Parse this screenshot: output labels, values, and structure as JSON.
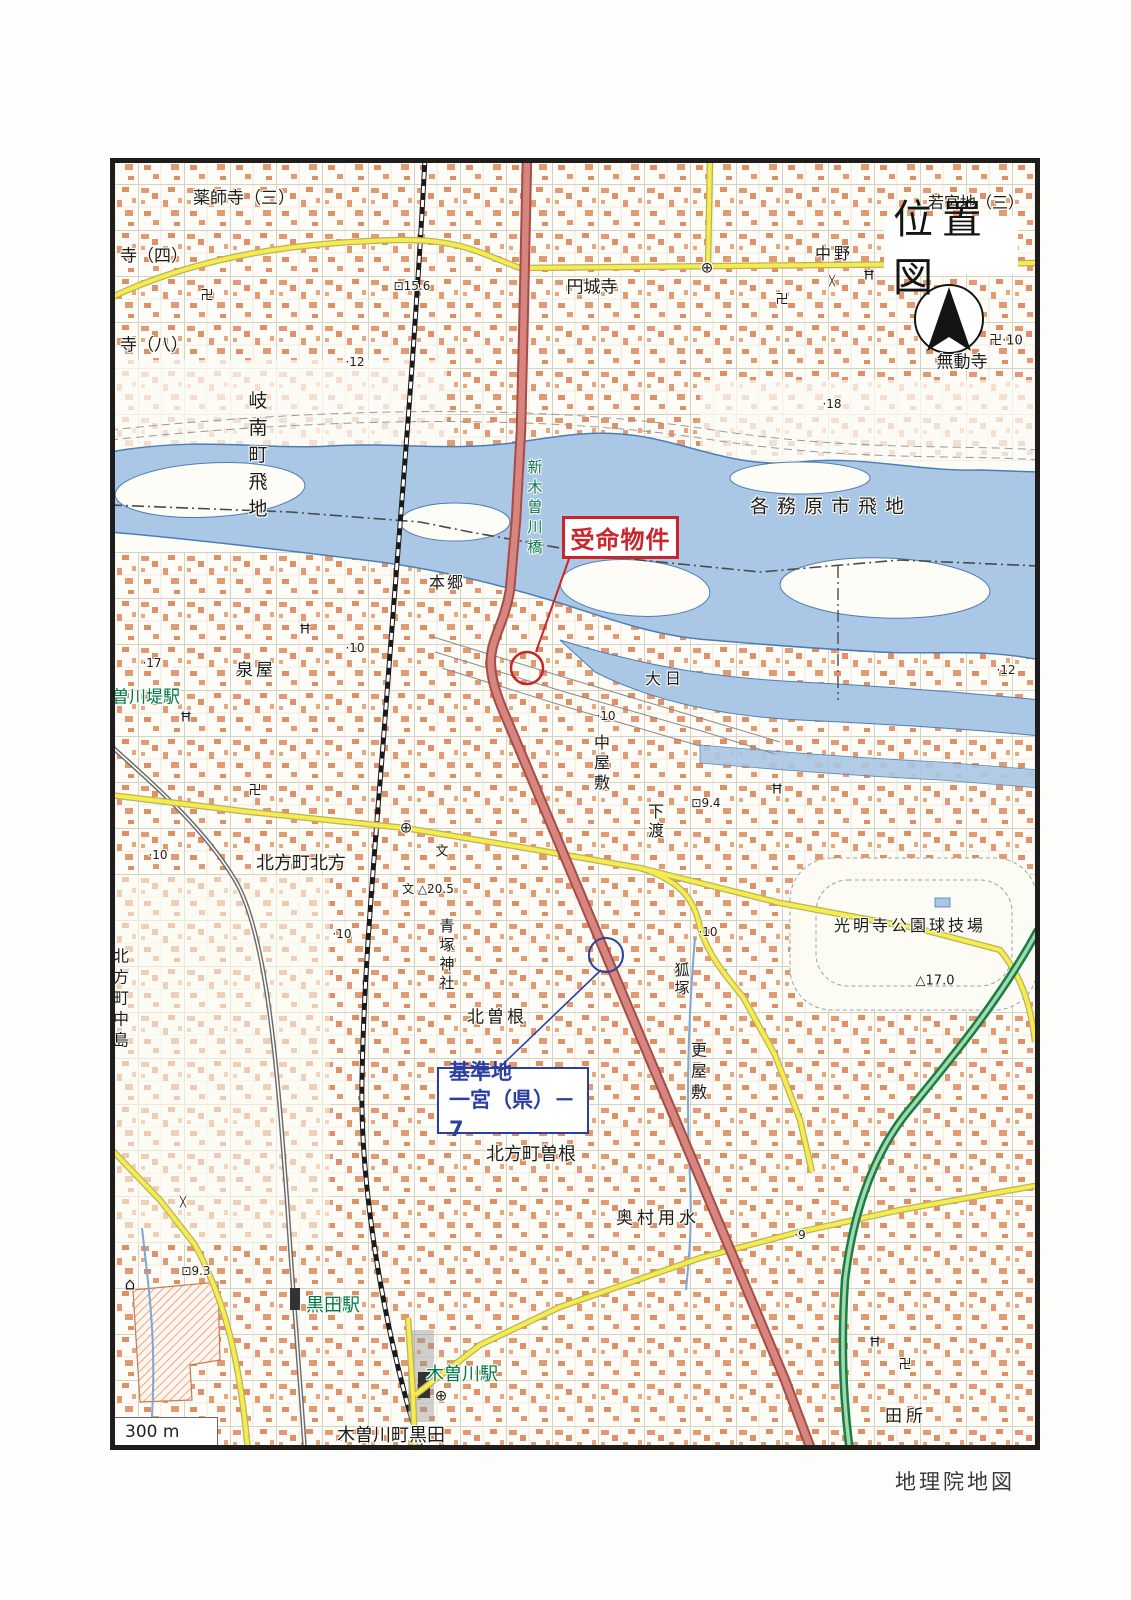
{
  "page": {
    "title_box": "位置図",
    "credit": "地理院地図",
    "scale_label": "300 m"
  },
  "annotations": {
    "subject": {
      "label": "受命物件",
      "color": "#c9252a"
    },
    "benchmark": {
      "line1": "基準地",
      "line2": "一宮（県）－7",
      "color": "#2a3fa0"
    }
  },
  "colors": {
    "river": "#aac7e5",
    "river_edge": "#4a7fb5",
    "road_major_fill": "#d6857f",
    "road_major_edge": "#a84b47",
    "road_minor_fill": "#f6ec4e",
    "road_minor_edge": "#b9b25f",
    "expressway": "#177f46",
    "expressway_inner": "#a6d7ae",
    "station_text": "#00794e",
    "building": "#e29a72"
  },
  "map": {
    "labels": [
      {
        "name": "yakushiji-3",
        "text": "薬師寺（三）",
        "x": 244,
        "y": 199,
        "size": 17
      },
      {
        "name": "tera-4",
        "text": "寺（四）",
        "x": 154,
        "y": 257,
        "size": 17
      },
      {
        "name": "tera-8",
        "text": "寺（八）",
        "x": 154,
        "y": 346,
        "size": 17
      },
      {
        "name": "wakamiyaji-3",
        "text": "若宮地（三）",
        "x": 976,
        "y": 203,
        "size": 16
      },
      {
        "name": "nakano",
        "text": "中野",
        "x": 834,
        "y": 254,
        "size": 16,
        "spacing": 3
      },
      {
        "name": "enjoji",
        "text": "円城寺",
        "x": 592,
        "y": 288,
        "size": 17
      },
      {
        "name": "spot-height-15-6",
        "text": "⊡15.6",
        "x": 412,
        "y": 286,
        "size": 12
      },
      {
        "name": "spot-height-12",
        "text": "·12",
        "x": 355,
        "y": 362,
        "size": 12
      },
      {
        "name": "spot-height-18",
        "text": "·18",
        "x": 832,
        "y": 404,
        "size": 12
      },
      {
        "name": "temple-spot-10",
        "text": "卍·10",
        "x": 1006,
        "y": 341,
        "size": 13
      },
      {
        "name": "mudoji",
        "text": "無動寺",
        "x": 962,
        "y": 363,
        "size": 17
      },
      {
        "name": "ginan-cho-tobichi",
        "text": "岐南町飛地",
        "x": 256,
        "y": 458,
        "size": 19,
        "vertical": true,
        "spacing": 8
      },
      {
        "name": "kakamigahara-shi-tobichi",
        "text": "各務原市飛地",
        "x": 831,
        "y": 507,
        "size": 19,
        "spacing": 8
      },
      {
        "name": "shin-kisogawa-bashi",
        "text": "新木曽川橋",
        "x": 534,
        "y": 509,
        "size": 15,
        "color": "#0a7a55",
        "vertical": true,
        "spacing": 5
      },
      {
        "name": "hongo",
        "text": "本郷",
        "x": 447,
        "y": 583,
        "size": 16,
        "spacing": 2
      },
      {
        "name": "dainichi",
        "text": "大日",
        "x": 665,
        "y": 679,
        "size": 16,
        "spacing": 4
      },
      {
        "name": "spot-height-12b",
        "text": "·12",
        "x": 1006,
        "y": 670,
        "size": 12
      },
      {
        "name": "spot-height-17",
        "text": "·17",
        "x": 152,
        "y": 663,
        "size": 12
      },
      {
        "name": "izumiya",
        "text": "泉屋",
        "x": 256,
        "y": 671,
        "size": 17,
        "spacing": 3
      },
      {
        "name": "spot-height-10a",
        "text": "·10",
        "x": 355,
        "y": 648,
        "size": 12
      },
      {
        "name": "kisogawatsutsumi-station",
        "text": "曽川堤駅",
        "x": 146,
        "y": 698,
        "size": 17,
        "color": "#00794e"
      },
      {
        "name": "spot-height-10b",
        "text": "·10",
        "x": 606,
        "y": 716,
        "size": 12
      },
      {
        "name": "nakayashiki",
        "text": "中屋敷",
        "x": 600,
        "y": 764,
        "size": 16,
        "vertical": true,
        "spacing": 4
      },
      {
        "name": "shimowatari",
        "text": "下渡",
        "x": 654,
        "y": 822,
        "size": 16,
        "vertical": true,
        "spacing": 3
      },
      {
        "name": "spot-height-9-4",
        "text": "⊡9.4",
        "x": 706,
        "y": 803,
        "size": 12
      },
      {
        "name": "spot-height-10f",
        "text": "·10",
        "x": 158,
        "y": 855,
        "size": 12
      },
      {
        "name": "kitagata-cho-kitagata",
        "text": "北方町北方",
        "x": 301,
        "y": 864,
        "size": 18
      },
      {
        "name": "school-mark-a",
        "text": "文",
        "x": 442,
        "y": 852,
        "size": 13
      },
      {
        "name": "school-triangulation-20-5",
        "text": "文 △20.5",
        "x": 428,
        "y": 889,
        "size": 12
      },
      {
        "name": "aotsuka-jinja",
        "text": "青塚神社",
        "x": 446,
        "y": 956,
        "size": 15,
        "vertical": true,
        "spacing": 4
      },
      {
        "name": "spot-height-10d",
        "text": "·10",
        "x": 342,
        "y": 934,
        "size": 12
      },
      {
        "name": "komyoji-park-stadium",
        "text": "光明寺公園球技場",
        "x": 910,
        "y": 926,
        "size": 16,
        "spacing": 3
      },
      {
        "name": "triangulation-17-0",
        "text": "△17.0",
        "x": 935,
        "y": 981,
        "size": 13
      },
      {
        "name": "spot-height-10e",
        "text": "·10",
        "x": 708,
        "y": 932,
        "size": 12
      },
      {
        "name": "kitsunezuka",
        "text": "狐塚",
        "x": 681,
        "y": 980,
        "size": 15,
        "vertical": true,
        "spacing": 3
      },
      {
        "name": "kitasone",
        "text": "北曽根",
        "x": 497,
        "y": 1018,
        "size": 17,
        "spacing": 3
      },
      {
        "name": "kitagata-cho-nakashima",
        "text": "北方町中島",
        "x": 119,
        "y": 1000,
        "size": 16,
        "vertical": true,
        "spacing": 5
      },
      {
        "name": "sarayashiki",
        "text": "更屋敷",
        "x": 697,
        "y": 1073,
        "size": 16,
        "vertical": true,
        "spacing": 5
      },
      {
        "name": "kitagata-cho-sone",
        "text": "北方町曽根",
        "x": 531,
        "y": 1155,
        "size": 18
      },
      {
        "name": "okumura-yosui",
        "text": "奥村用水",
        "x": 658,
        "y": 1219,
        "size": 17,
        "spacing": 4
      },
      {
        "name": "spot-height-9",
        "text": "·9",
        "x": 800,
        "y": 1235,
        "size": 12
      },
      {
        "name": "spot-height-9-3",
        "text": "⊡9.3",
        "x": 196,
        "y": 1271,
        "size": 12
      },
      {
        "name": "home-icon",
        "text": "⌂",
        "x": 130,
        "y": 1285,
        "size": 17
      },
      {
        "name": "kuroda-station",
        "text": "黒田駅",
        "x": 333,
        "y": 1306,
        "size": 18,
        "color": "#00794e"
      },
      {
        "name": "kisogawa-station",
        "text": "木曽川駅",
        "x": 462,
        "y": 1375,
        "size": 18,
        "color": "#00794e"
      },
      {
        "name": "kisogawa-cho-kuroda",
        "text": "木曽川町黒田",
        "x": 391,
        "y": 1436,
        "size": 18
      },
      {
        "name": "tadokoro",
        "text": "田所",
        "x": 906,
        "y": 1417,
        "size": 17,
        "spacing": 4
      },
      {
        "name": "temple-a",
        "text": "卍",
        "x": 782,
        "y": 300,
        "size": 13
      },
      {
        "name": "temple-b",
        "text": "卍",
        "x": 207,
        "y": 296,
        "size": 13
      },
      {
        "name": "temple-c",
        "text": "卍",
        "x": 255,
        "y": 791,
        "size": 13
      },
      {
        "name": "temple-d",
        "text": "卍",
        "x": 905,
        "y": 1365,
        "size": 13
      },
      {
        "name": "shrine-a",
        "text": "Ħ",
        "x": 186,
        "y": 718,
        "size": 13
      },
      {
        "name": "shrine-b",
        "text": "Ħ",
        "x": 305,
        "y": 630,
        "size": 13
      },
      {
        "name": "shrine-c",
        "text": "Ħ",
        "x": 777,
        "y": 790,
        "size": 13
      },
      {
        "name": "shrine-d",
        "text": "Ħ",
        "x": 869,
        "y": 276,
        "size": 13
      },
      {
        "name": "shrine-e",
        "text": "Ħ",
        "x": 875,
        "y": 1343,
        "size": 13
      },
      {
        "name": "town-office-a",
        "text": "⊕",
        "x": 406,
        "y": 828,
        "size": 15
      },
      {
        "name": "town-office-b",
        "text": "⊕",
        "x": 707,
        "y": 268,
        "size": 15
      },
      {
        "name": "station-mark",
        "text": "⊕",
        "x": 441,
        "y": 1396,
        "size": 15
      },
      {
        "name": "crossing-x-a",
        "text": "╳",
        "x": 832,
        "y": 282,
        "size": 10
      },
      {
        "name": "crossing-x-b",
        "text": "╳",
        "x": 183,
        "y": 1203,
        "size": 10
      }
    ]
  }
}
